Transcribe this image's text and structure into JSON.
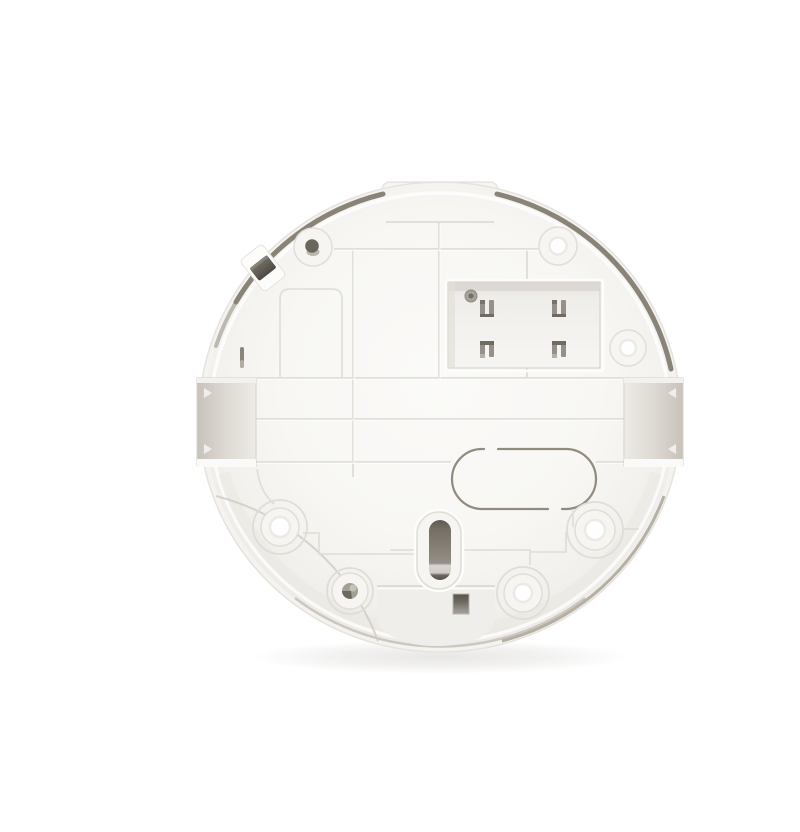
{
  "meta": {
    "description": "Rear view product photo of a round white plastic mounting backplate (ceiling smoke detector style) centered on a plain white background. No text, buttons or UI controls are visible.",
    "aria_label": "White circular plastic device backplate, rear view, on white background"
  },
  "colors": {
    "bg": "#ffffff",
    "shell": "#f4f3f0",
    "shelledge": "#e6e3dd",
    "face2": "#f6f5f2",
    "rib": "#e1ded8",
    "ribhi": "#ffffff",
    "trace": "#e0ddd6",
    "rimdark": "#8a8377",
    "rimlight": "#b0aaa0",
    "rimbottom": "#c8c3ba",
    "boxline": "#d2cec7",
    "metal": "#95908a",
    "metaldark": "#6f6a62",
    "slotdark": "#5f5a52",
    "clip": "#55514a",
    "pocketdeep": "#c9c4bc",
    "white": "#ffffff"
  },
  "parts": [
    "mounting-tab-top",
    "outer-shell",
    "face",
    "rim-arc-left",
    "rim-arc-right",
    "rib-grid",
    "battery-compartment",
    "battery-contacts",
    "compartment-screw",
    "cable-knockout-oval",
    "keyhole-slot",
    "bottom-recess",
    "square-hole",
    "side-pocket-left",
    "side-pocket-right",
    "screw-bosses",
    "rim-clip",
    "side-slot"
  ]
}
